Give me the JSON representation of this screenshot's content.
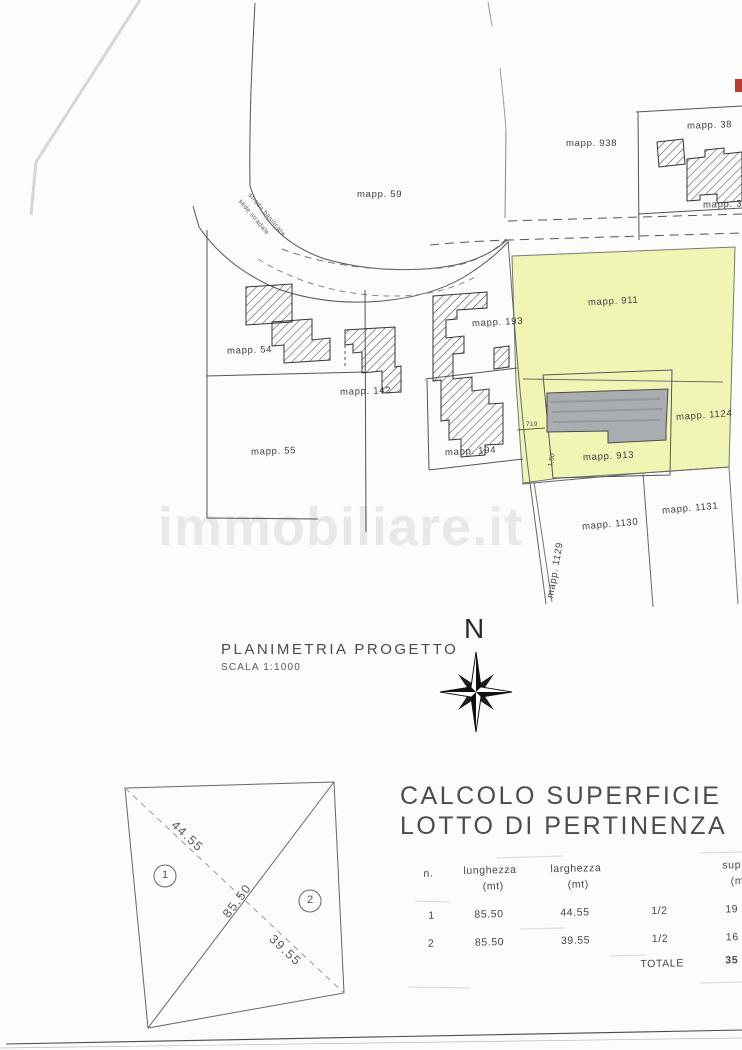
{
  "plan": {
    "watermark": "immobiliare.it",
    "compass_label": "N",
    "title": "PLANIMETRIA PROGETTO",
    "scale": "SCALA 1:1000",
    "road_label": {
      "line1": "strada basilicata",
      "line2": "sede stradale"
    },
    "parcels": [
      {
        "id": "mapp-938",
        "text": "mapp. 938"
      },
      {
        "id": "mapp-38",
        "text": "mapp. 38"
      },
      {
        "id": "mapp-39",
        "text": "mapp. 39"
      },
      {
        "id": "mapp-59",
        "text": "mapp. 59"
      },
      {
        "id": "mapp-54",
        "text": "mapp. 54"
      },
      {
        "id": "mapp-55",
        "text": "mapp. 55"
      },
      {
        "id": "mapp-142",
        "text": "mapp. 142"
      },
      {
        "id": "mapp-193",
        "text": "mapp. 193"
      },
      {
        "id": "mapp-194",
        "text": "mapp. 194"
      },
      {
        "id": "mapp-911",
        "text": "mapp. 911"
      },
      {
        "id": "mapp-1124",
        "text": "mapp. 1124"
      },
      {
        "id": "mapp-913",
        "text": "mapp. 913"
      },
      {
        "id": "mapp-1130",
        "text": "mapp. 1130"
      },
      {
        "id": "mapp-1131",
        "text": "mapp. 1131"
      },
      {
        "id": "mapp-1129",
        "text": "mapp. 1129"
      }
    ],
    "dimensions": {
      "d719": "719",
      "d150": "1,50"
    },
    "colors": {
      "parcel_yellow": "#eef3a2",
      "building_gray": "#a9adb2",
      "hatch": "#4a4a4a",
      "red_mark": "#c0392e"
    }
  },
  "survey": {
    "region1": "1",
    "region2": "2",
    "diag_a": "44.55",
    "diag_b": "85.50",
    "diag_c": "39.55"
  },
  "table": {
    "title1": "CALCOLO SUPERFICIE",
    "title2": "LOTTO DI PERTINENZA",
    "col_n": "n.",
    "col_lunghezza": "lunghezza",
    "col_lunghezza_unit": "(mt)",
    "col_larghezza": "larghezza",
    "col_larghezza_unit": "(mt)",
    "col_sup": "sup",
    "col_sup_unit": "(m",
    "rows": [
      {
        "n": "1",
        "lunghezza": "85.50",
        "larghezza": "44.55",
        "factor": "1/2",
        "sup": "19"
      },
      {
        "n": "2",
        "lunghezza": "85.50",
        "larghezza": "39.55",
        "factor": "1/2",
        "sup": "16"
      }
    ],
    "total_label": "TOTALE",
    "total_value": "35"
  }
}
